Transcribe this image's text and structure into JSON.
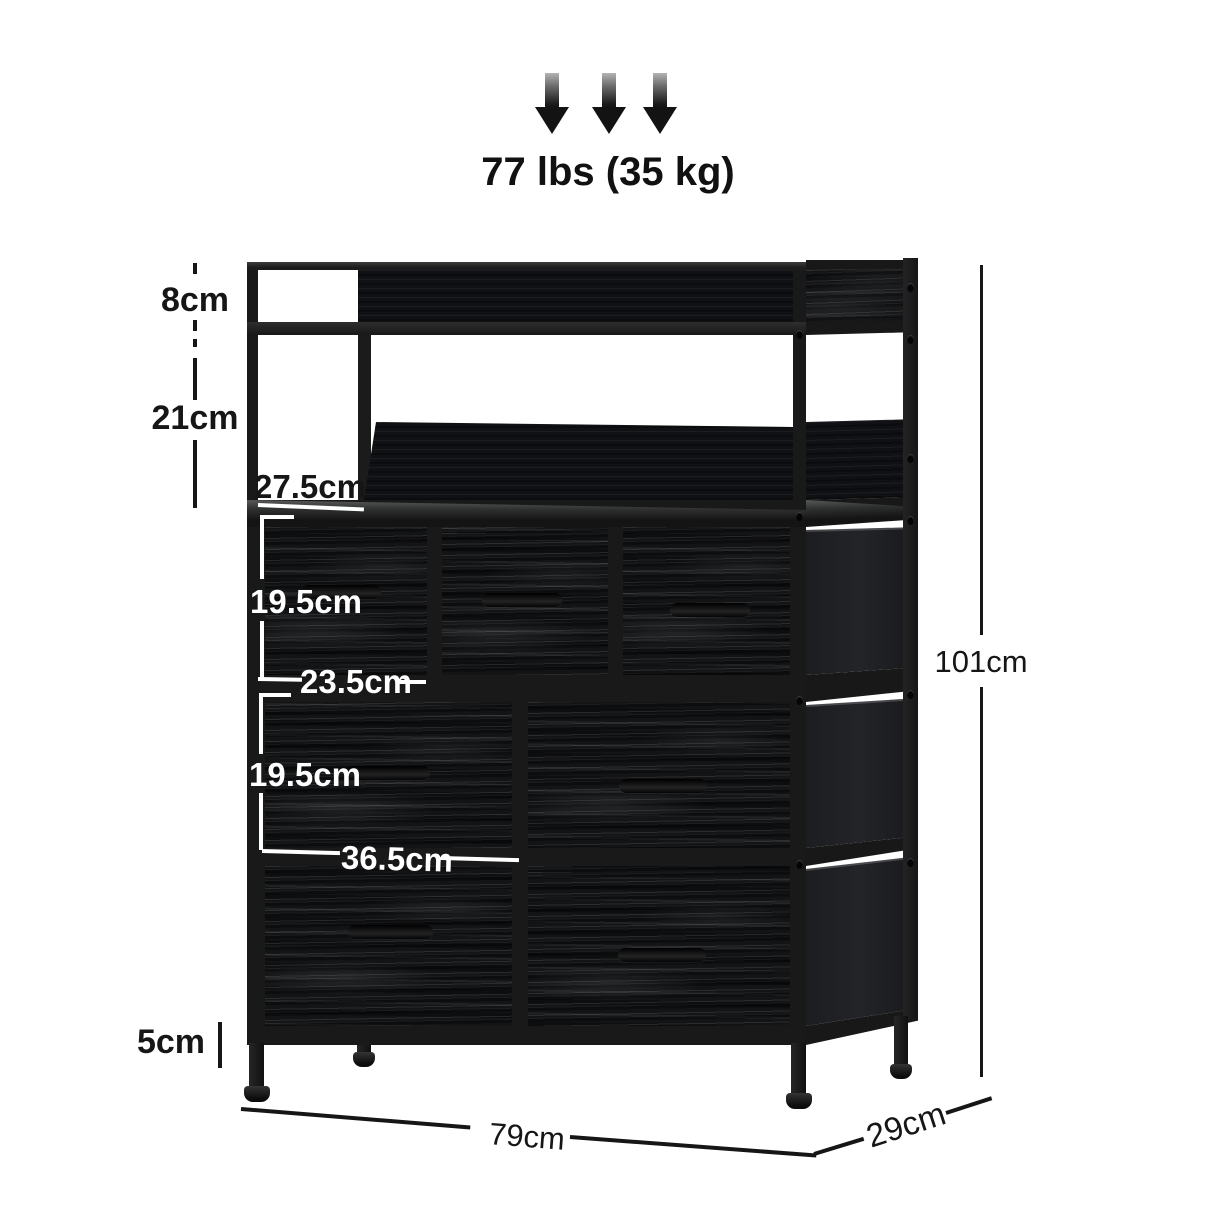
{
  "capacity_label": "77 lbs (35 kg)",
  "labels": {
    "top_shelf_height": "8cm",
    "open_shelf_height": "21cm",
    "shelf_opening_width": "27.5cm",
    "small_drawer_height": "19.5cm",
    "small_drawer_width": "23.5cm",
    "large_drawer_height": "19.5cm",
    "large_drawer_width": "36.5cm",
    "foot_height": "5cm",
    "overall_width": "79cm",
    "overall_depth": "29cm",
    "overall_height": "101cm"
  },
  "icons": [
    "down-arrow-icon"
  ],
  "colors": {
    "frame": "#191919",
    "drawer_wood": "#131416",
    "back_panel": "#101114",
    "side_fabric": "#1e1f22",
    "annotation_black": "#161616",
    "annotation_white": "#ffffff",
    "arrow_gradient_top": "#b4b4b4",
    "arrow_dark": "#131313"
  }
}
